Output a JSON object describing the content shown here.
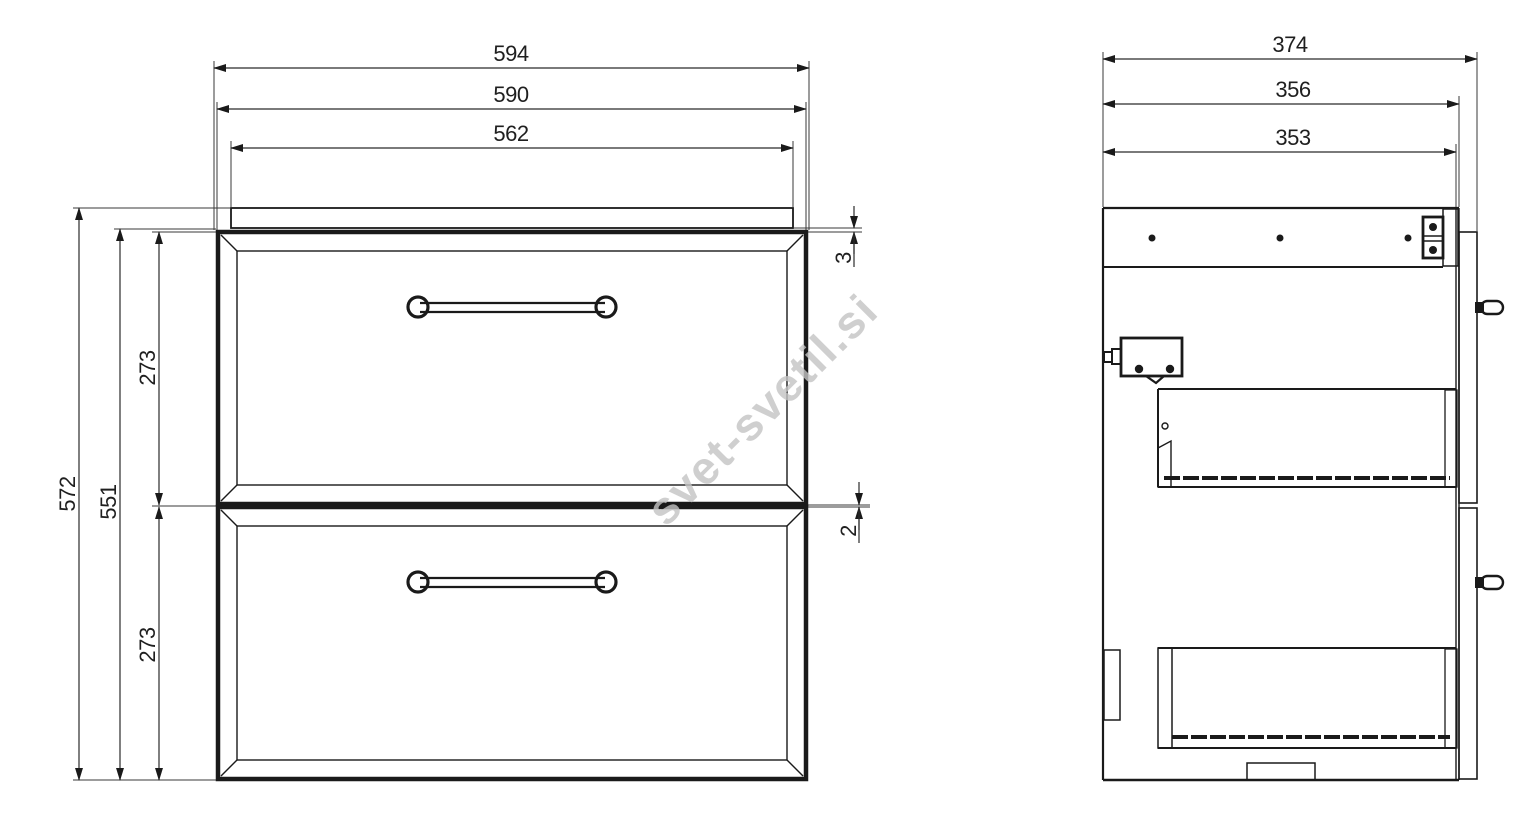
{
  "watermark": {
    "text": "svet-svetil.si"
  },
  "front_view": {
    "dims": {
      "overall_width": "594",
      "cabinet_width": "590",
      "countertop_width": "562",
      "overall_height": "572",
      "front_assembly_height": "551",
      "upper_drawer_height": "273",
      "lower_drawer_height": "273",
      "countertop_to_drawer_gap": "3",
      "between_drawers_gap": "2"
    }
  },
  "side_view": {
    "dims": {
      "overall_depth": "374",
      "cabinet_depth": "356",
      "inner_depth": "353"
    }
  }
}
